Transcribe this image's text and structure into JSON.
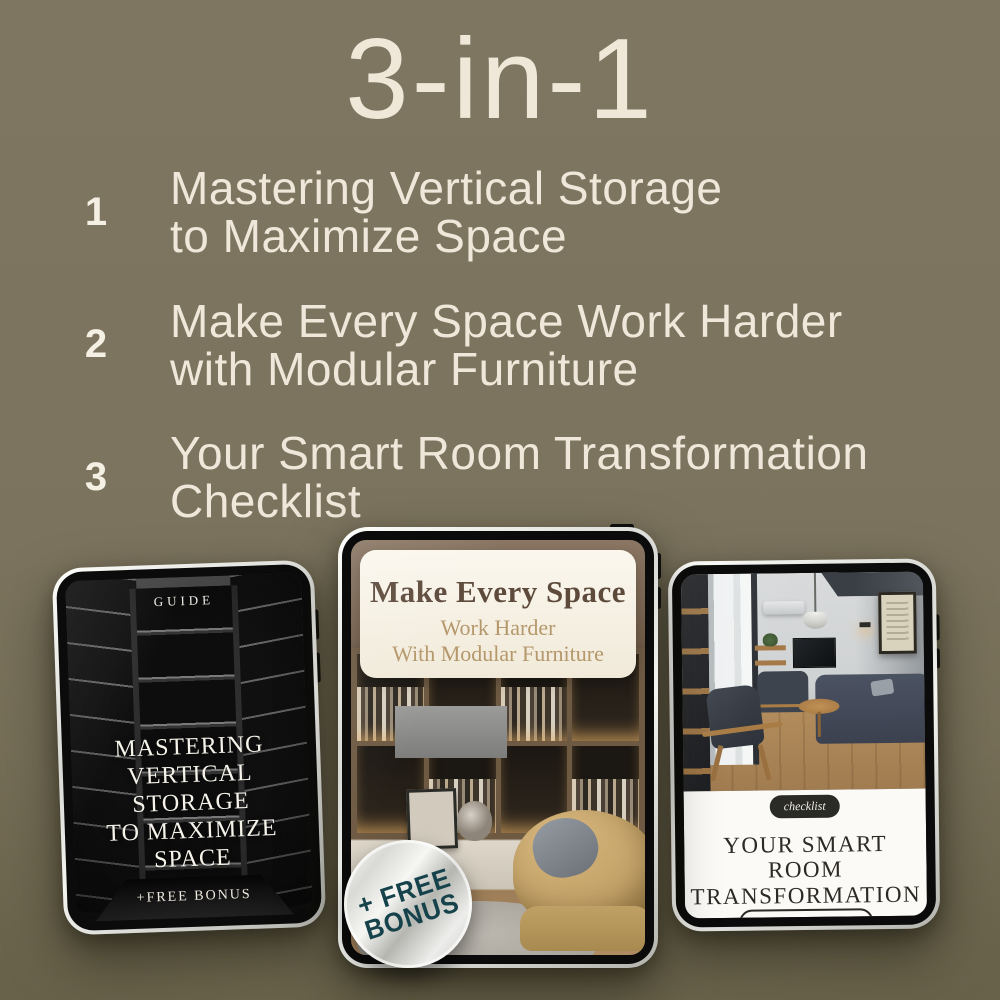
{
  "header": {
    "title": "3-in-1"
  },
  "list": [
    {
      "number": "1",
      "line1": "Mastering Vertical Storage",
      "line2": "to Maximize Space"
    },
    {
      "number": "2",
      "line1": "Make Every Space Work Harder",
      "line2": "with Modular Furniture"
    },
    {
      "number": "3",
      "line1": "Your Smart Room Transformation",
      "line2": "Checklist"
    }
  ],
  "tablets": {
    "left": {
      "tag": "GUIDE",
      "title_lines": [
        "MASTERING",
        "VERTICAL",
        "STORAGE",
        "TO MAXIMIZE",
        "SPACE"
      ],
      "footer": "+FREE BONUS"
    },
    "middle": {
      "heading": "Make Every Space",
      "subheading1": "Work Harder",
      "subheading2": "With Modular Furniture",
      "badge": {
        "line1": "+ FREE",
        "line2": "BONUS"
      }
    },
    "right": {
      "tag": "checklist",
      "title_line1": "YOUR SMART ROOM",
      "title_line2": "TRANSFORMATION",
      "footer": "+FREE BONUS"
    }
  },
  "colors": {
    "background": "#7b735d",
    "cream_text": "#efe8da",
    "heading_brown": "#5d4a3b",
    "heading_gold": "#b4976a",
    "badge_teal": "#16424b"
  }
}
